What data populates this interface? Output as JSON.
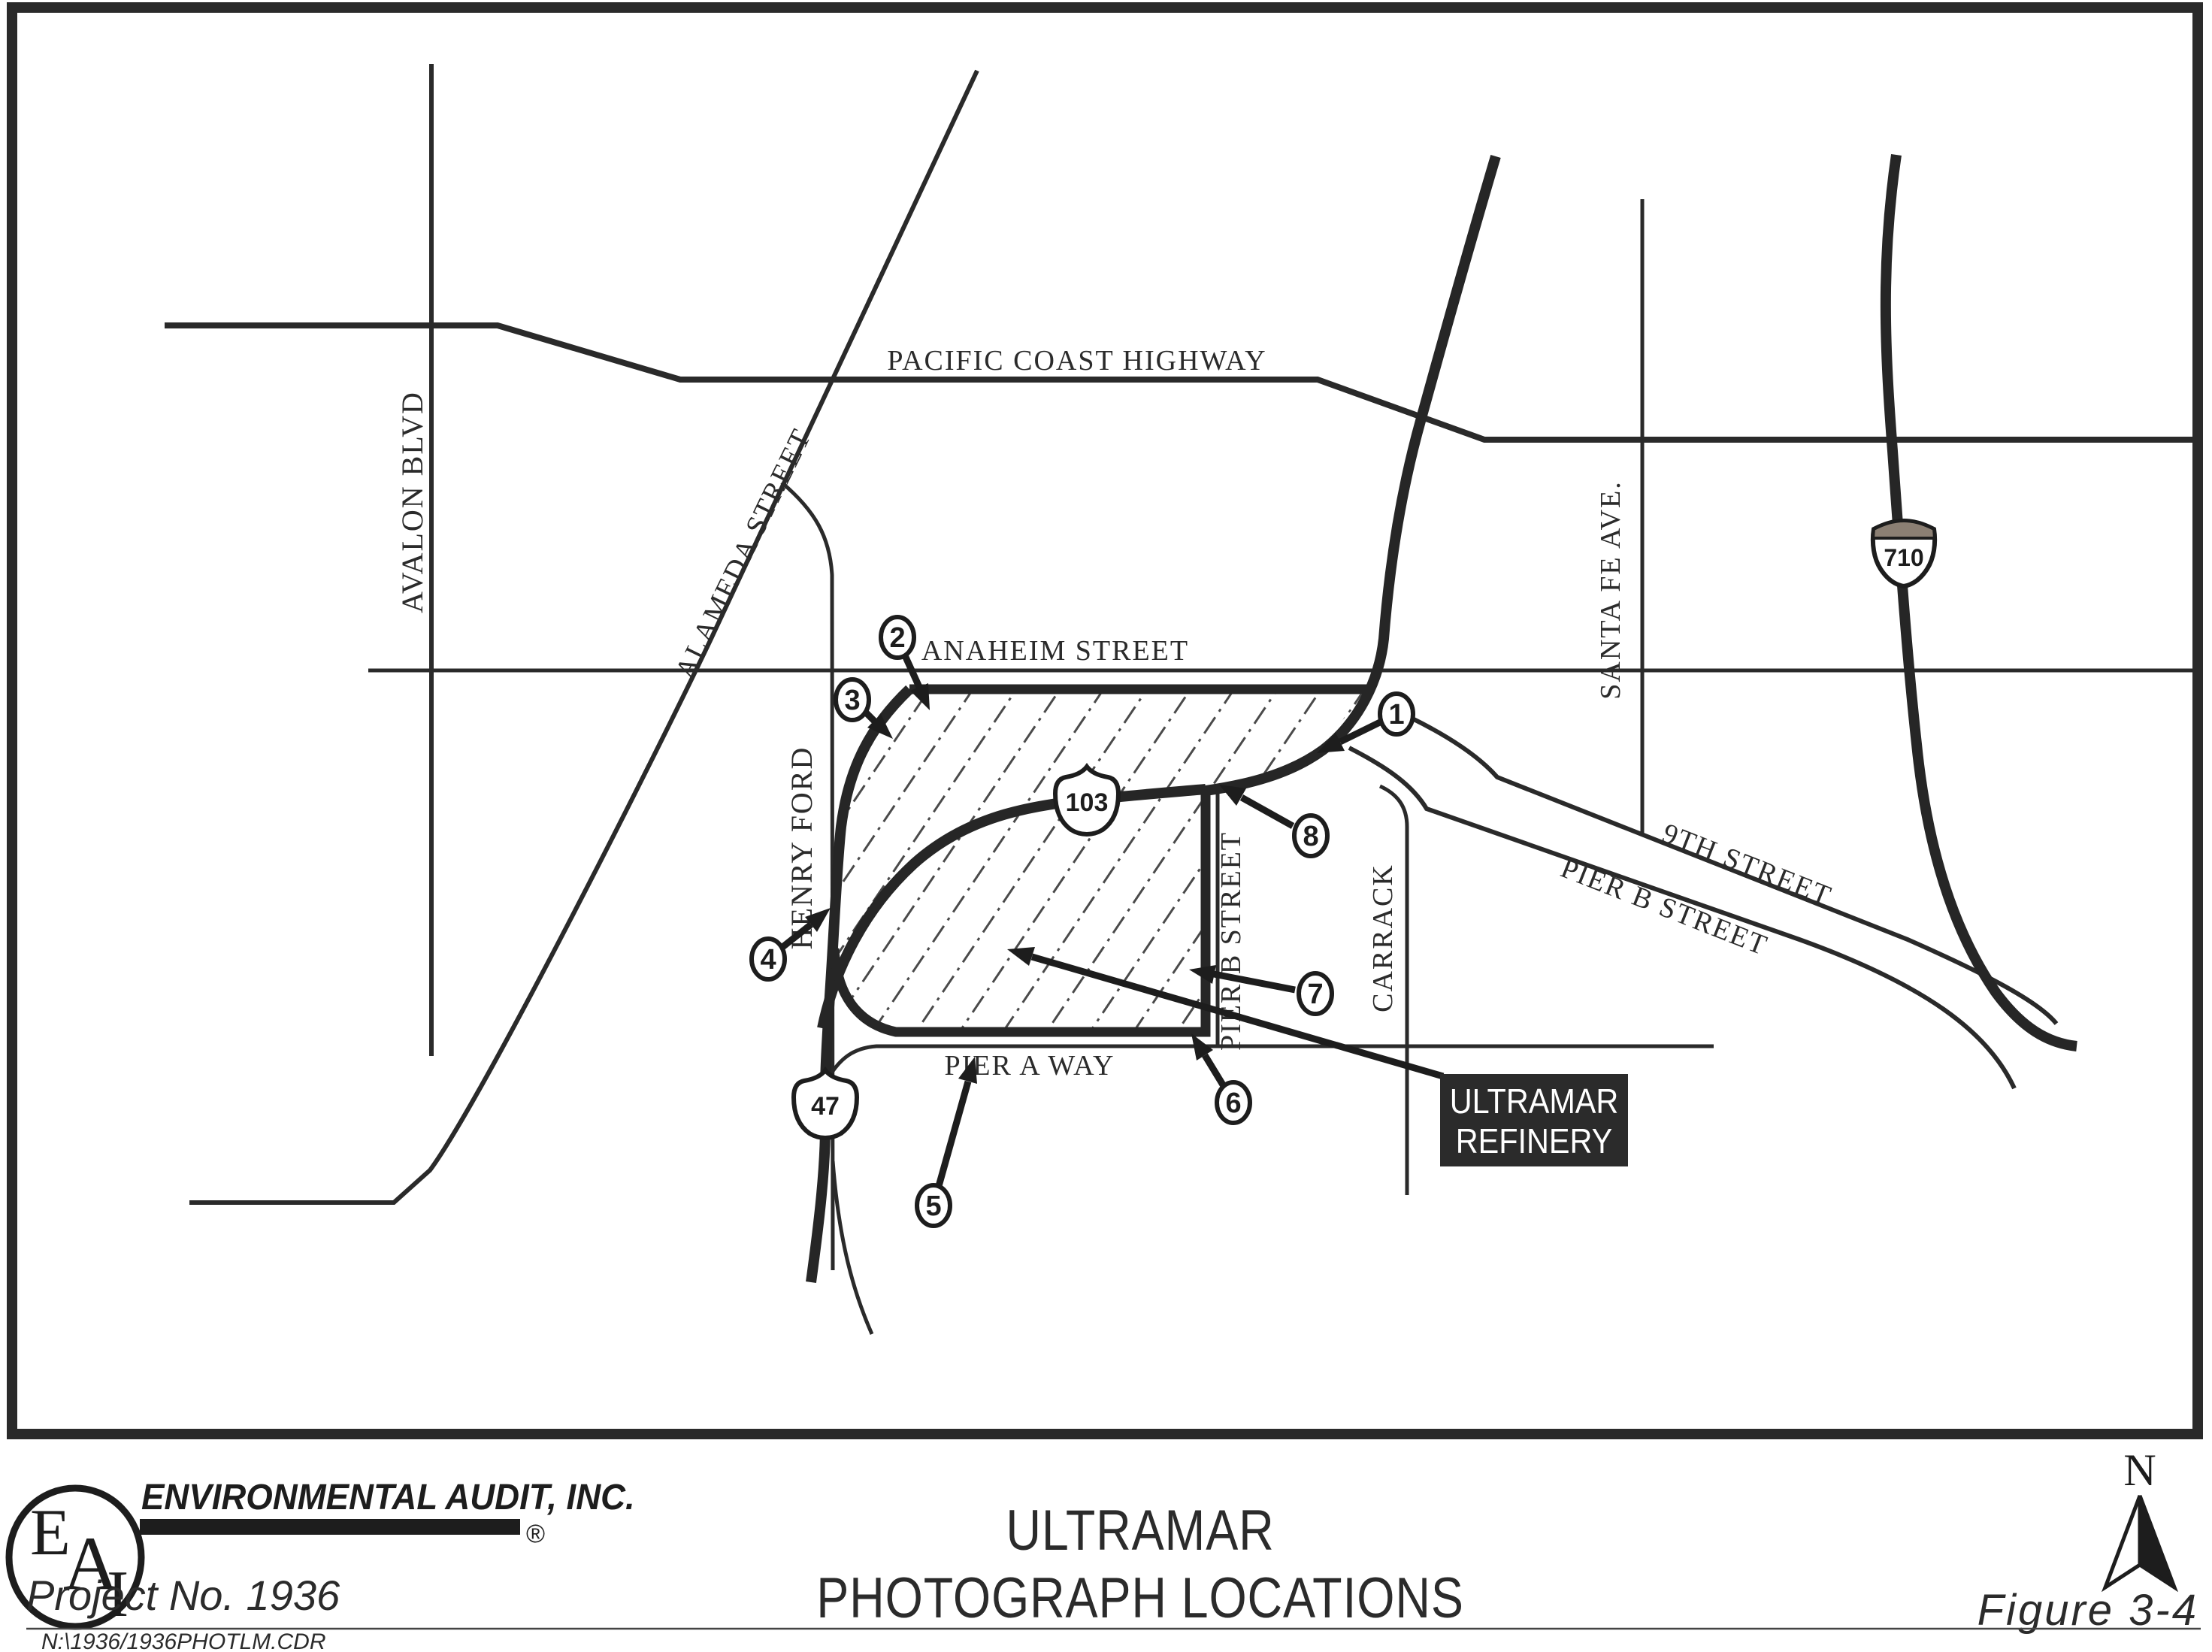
{
  "map": {
    "streets": {
      "pacific_coast_highway": "PACIFIC COAST HIGHWAY",
      "avalon_blvd": "AVALON BLVD",
      "alameda_street": "ALAMEDA STREET",
      "anaheim_street": "ANAHEIM STREET",
      "henry_ford": "HENRY FORD",
      "santa_fe_ave": "SANTA FE AVE.",
      "ninth_street": "9TH STREET",
      "pier_b_street_diagonal": "PIER B STREET",
      "pier_b_street_vertical": "PIER B STREET",
      "carrack": "CARRACK",
      "pier_a_way": "PIER A WAY"
    },
    "route_shields": {
      "state_103": "103",
      "state_47": "47",
      "interstate_710": "710"
    },
    "photo_locations": [
      "1",
      "2",
      "3",
      "4",
      "5",
      "6",
      "7",
      "8"
    ],
    "refinery_box": {
      "line1": "ULTRAMAR",
      "line2": "REFINERY"
    }
  },
  "footer": {
    "logo_letters": {
      "e": "E",
      "a": "A",
      "i": "I"
    },
    "company_name": "ENVIRONMENTAL AUDIT, INC.",
    "registered_mark": "®",
    "project_no": "Project No. 1936",
    "title_line1": "ULTRAMAR",
    "title_line2": "PHOTOGRAPH LOCATIONS",
    "figure_label": "Figure 3-4",
    "north_label": "N",
    "file_path": "N:\\1936/1936PHOTLM.CDR"
  }
}
